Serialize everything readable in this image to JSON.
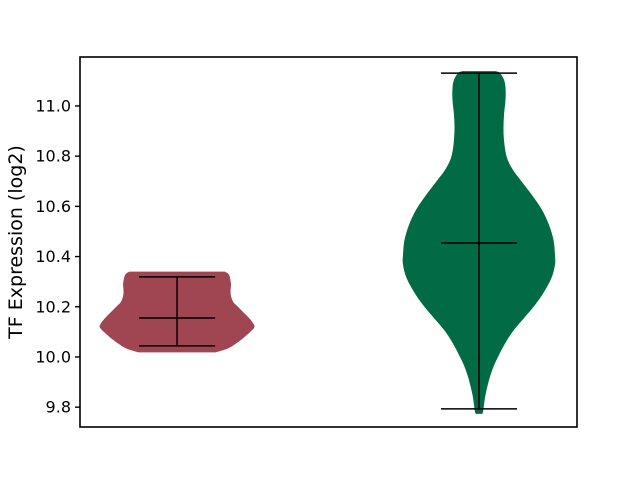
{
  "figure": {
    "background": "#ffffff",
    "spine_color": "#000000",
    "tick_color": "#000000",
    "text_color": "#000000"
  },
  "chart_data": {
    "type": "violin",
    "title": "",
    "xlabel": "",
    "ylabel": "TF Expression (log2)",
    "ylim": [
      9.721,
      11.195
    ],
    "grid": false,
    "legend": "none",
    "x_tick_labels": [],
    "yticks": [
      {
        "value": 11.0,
        "label": "11.0"
      },
      {
        "value": 10.8,
        "label": "10.8"
      },
      {
        "value": 10.6,
        "label": "10.6"
      },
      {
        "value": 10.4,
        "label": "10.4"
      },
      {
        "value": 10.2,
        "label": "10.2"
      },
      {
        "value": 10.0,
        "label": "10.0"
      },
      {
        "value": 9.8,
        "label": "9.8"
      }
    ],
    "stat_line_color": "#000000",
    "violins": [
      {
        "position": 1,
        "x_frac": 0.1953,
        "fill_color": "#a04552",
        "max_halfwidth_frac": 0.155,
        "cap_halfwidth_frac": 0.0765,
        "stats": {
          "min": 10.044,
          "median": 10.155,
          "max": 10.319
        },
        "profile": [
          [
            10.34,
            0.62
          ],
          [
            10.327,
            0.675
          ],
          [
            10.291,
            0.7
          ],
          [
            10.267,
            0.695
          ],
          [
            10.243,
            0.7
          ],
          [
            10.219,
            0.73
          ],
          [
            10.203,
            0.78
          ],
          [
            10.179,
            0.857
          ],
          [
            10.155,
            0.935
          ],
          [
            10.131,
            0.994
          ],
          [
            10.116,
            1.0
          ],
          [
            10.092,
            0.922
          ],
          [
            10.068,
            0.83
          ],
          [
            10.048,
            0.74
          ],
          [
            10.036,
            0.675
          ],
          [
            10.028,
            0.61
          ],
          [
            10.018,
            0.5
          ]
        ]
      },
      {
        "position": 2,
        "x_frac": 0.8028,
        "fill_color": "#006b45",
        "max_halfwidth_frac": 0.1529,
        "cap_halfwidth_frac": 0.0765,
        "stats": {
          "min": 9.793,
          "median": 10.454,
          "max": 11.131
        },
        "profile": [
          [
            11.139,
            0.22
          ],
          [
            11.131,
            0.276
          ],
          [
            11.104,
            0.329
          ],
          [
            11.072,
            0.349
          ],
          [
            11.024,
            0.349
          ],
          [
            10.964,
            0.329
          ],
          [
            10.904,
            0.322
          ],
          [
            10.845,
            0.336
          ],
          [
            10.793,
            0.368
          ],
          [
            10.745,
            0.447
          ],
          [
            10.697,
            0.566
          ],
          [
            10.645,
            0.697
          ],
          [
            10.586,
            0.829
          ],
          [
            10.526,
            0.921
          ],
          [
            10.466,
            0.98
          ],
          [
            10.406,
            1.0
          ],
          [
            10.367,
            1.0
          ],
          [
            10.315,
            0.954
          ],
          [
            10.259,
            0.855
          ],
          [
            10.207,
            0.737
          ],
          [
            10.155,
            0.592
          ],
          [
            10.108,
            0.461
          ],
          [
            10.06,
            0.355
          ],
          [
            10.008,
            0.263
          ],
          [
            9.956,
            0.184
          ],
          [
            9.9,
            0.125
          ],
          [
            9.849,
            0.086
          ],
          [
            9.809,
            0.066
          ],
          [
            9.781,
            0.053
          ],
          [
            9.773,
            0.04
          ]
        ]
      }
    ]
  }
}
